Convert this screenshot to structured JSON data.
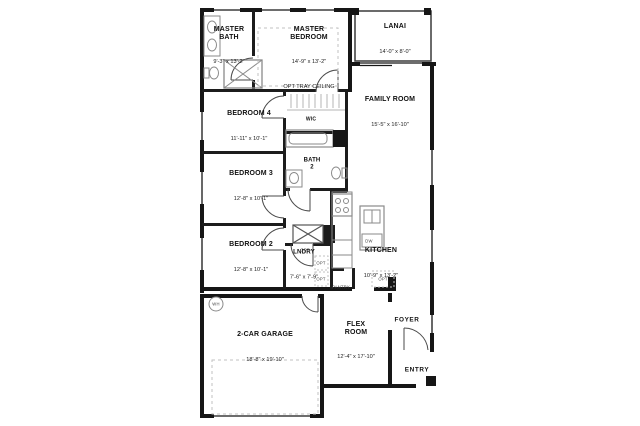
{
  "rooms": [
    {
      "key": "master_bath",
      "name": "MASTER\nBATH",
      "dims": "9'-3\" x 13'-2\""
    },
    {
      "key": "master_bedroom",
      "name": "MASTER\nBEDROOM",
      "dims": "14'-9\" x 13'-2\"",
      "note": "OPT TRAY CEILING"
    },
    {
      "key": "lanai",
      "name": "LANAI",
      "dims": "14'-0\" x 8'-0\""
    },
    {
      "key": "family_room",
      "name": "FAMILY ROOM",
      "dims": "15'-5\" x 16'-10\""
    },
    {
      "key": "bedroom_4",
      "name": "BEDROOM 4",
      "dims": "11'-11\" x 10'-1\""
    },
    {
      "key": "wic",
      "name": "WIC"
    },
    {
      "key": "bath_2",
      "name": "BATH\n2"
    },
    {
      "key": "bedroom_3",
      "name": "BEDROOM 3",
      "dims": "12'-8\" x 10'-1\""
    },
    {
      "key": "bedroom_2",
      "name": "BEDROOM 2",
      "dims": "12'-8\" x 10'-1\""
    },
    {
      "key": "laundry",
      "name": "LNDRY",
      "dims": "7'-6\" x 7'-9\""
    },
    {
      "key": "kitchen",
      "name": "KITCHEN",
      "dims": "10'-9\" x 13'-2\""
    },
    {
      "key": "garage",
      "name": "2-CAR GARAGE",
      "dims": "18'-8\" x 19'-10\""
    },
    {
      "key": "flex_room",
      "name": "FLEX\nROOM",
      "dims": "12'-4\" x 17'-10\""
    },
    {
      "key": "foyer",
      "name": "FOYER"
    },
    {
      "key": "entry",
      "name": "ENTRY"
    }
  ],
  "annotations": {
    "dw": "DW",
    "pantry": "PANTRY",
    "wh": "WH",
    "opt": "OPT"
  },
  "colors": {
    "wall": "#161616",
    "fixture": "#8a8a8a",
    "background": "#ffffff"
  }
}
